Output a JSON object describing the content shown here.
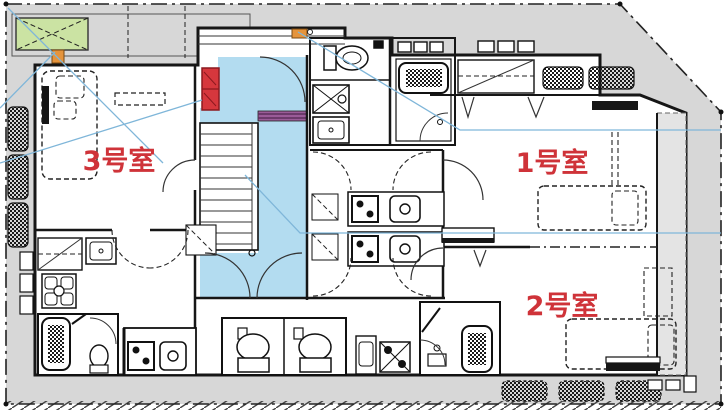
{
  "document": {
    "type": "architectural-floor-plan"
  },
  "rooms": [
    {
      "id": "room-3",
      "label": "3号室"
    },
    {
      "id": "room-1",
      "label": "1号室"
    },
    {
      "id": "room-2",
      "label": "2号室"
    }
  ],
  "colors": {
    "ground": "#d7d7d7",
    "ground2": "#e4e4e4",
    "wall": "#161616",
    "hall": "#b3dcf0",
    "leader": "#7fb6d9",
    "green": "#cbe3a3",
    "red": "#d6373d",
    "reddark": "#8c191f",
    "orange": "#e5943c",
    "purple": "#9a5b98",
    "label": "#cf3339"
  },
  "fixtures": [
    "staircase",
    "entrance-hall",
    "corridor",
    "toilet",
    "bathtub",
    "kitchen-sink",
    "stove",
    "washing-machine",
    "bicycle-parking",
    "planter",
    "locker",
    "entry-mat",
    "bed",
    "closet",
    "bench"
  ]
}
